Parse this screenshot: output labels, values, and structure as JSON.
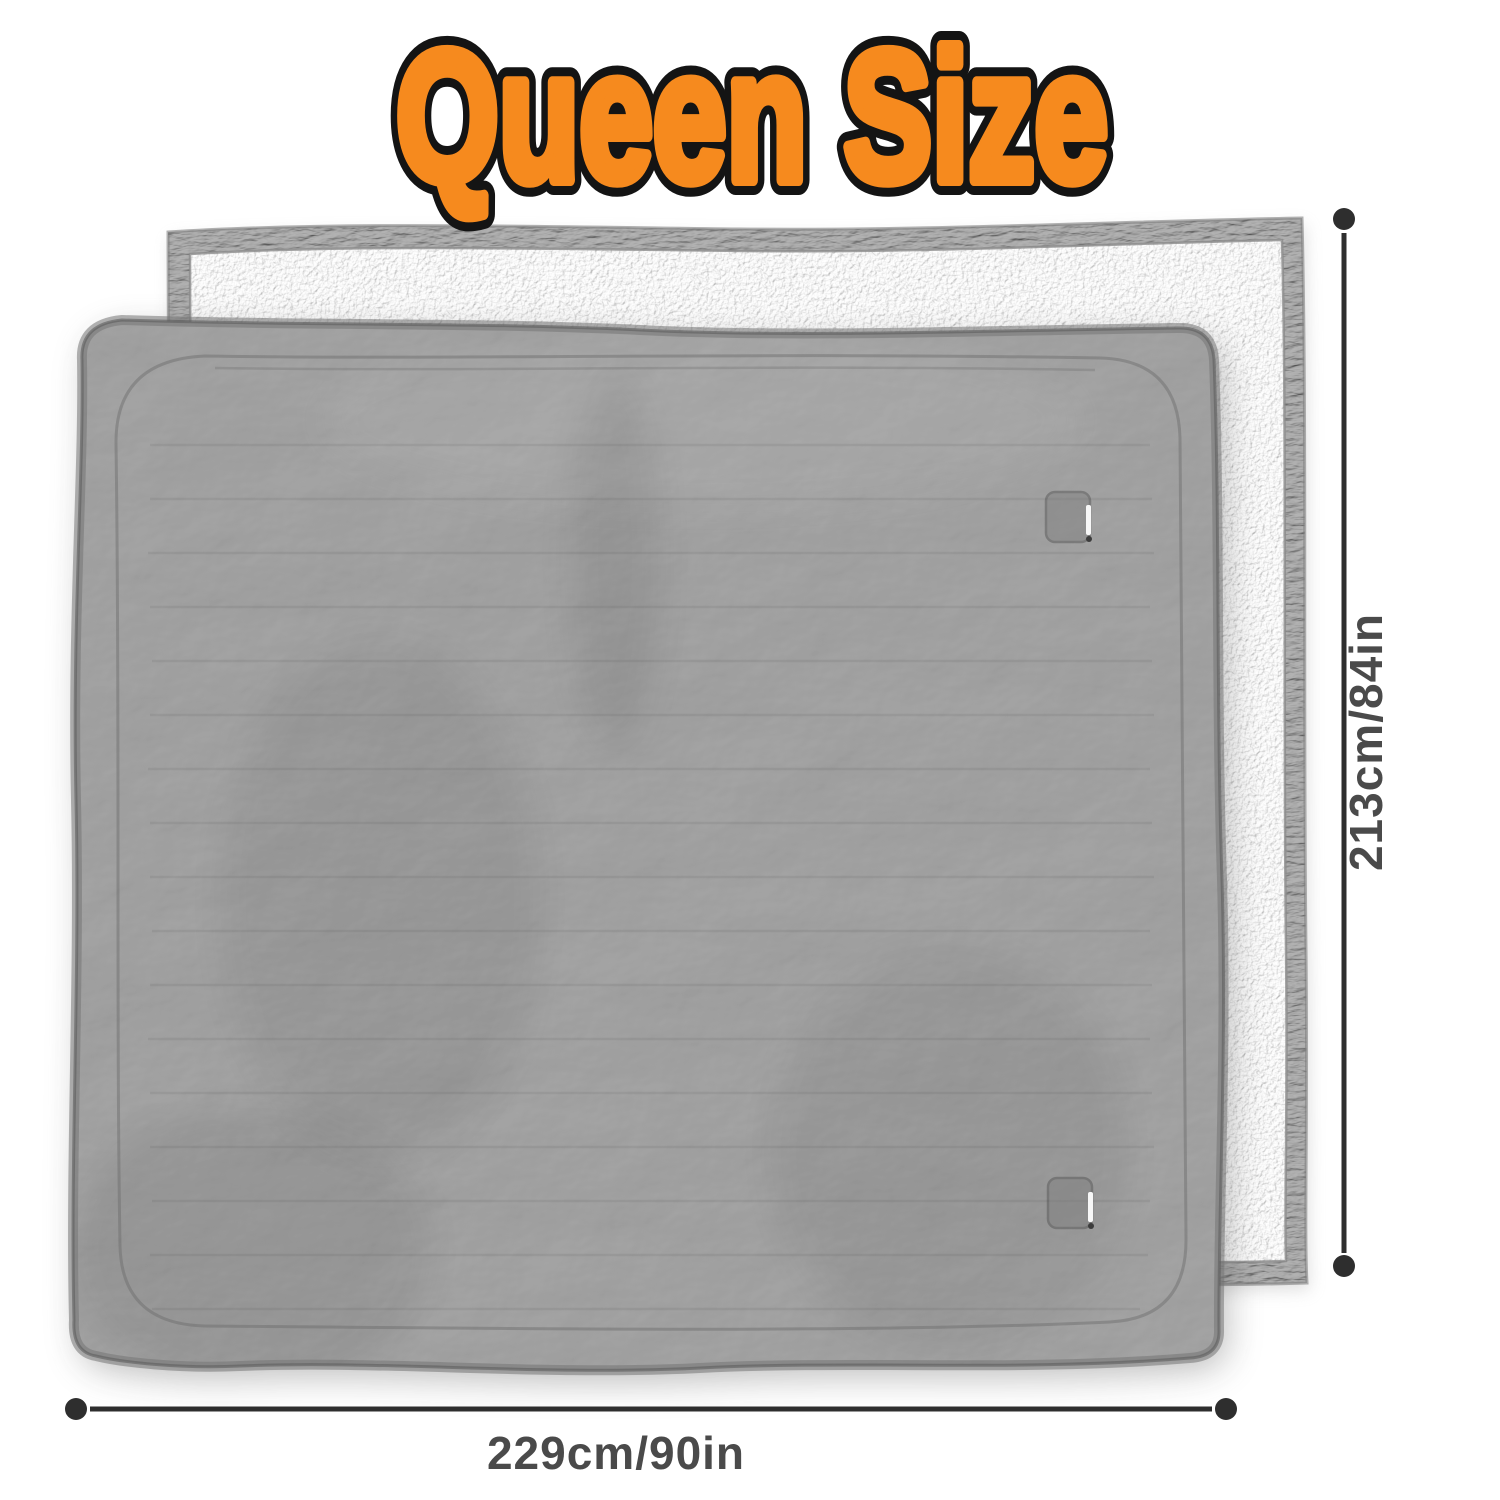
{
  "title": {
    "text": "Queen Size"
  },
  "dimensions": {
    "height_label": "213cm/84in",
    "width_label": "229cm/90in"
  },
  "colors": {
    "accent_orange": "#F68A1E",
    "outline_black": "#141414",
    "dimension_line": "#2E2E2E",
    "dimension_text": "#4A4A4A",
    "blanket_front_gray": "#909090",
    "blanket_back_white": "#F2F0EC",
    "blanket_trim_gray": "#9A9A9A",
    "background": "#FFFFFF"
  }
}
